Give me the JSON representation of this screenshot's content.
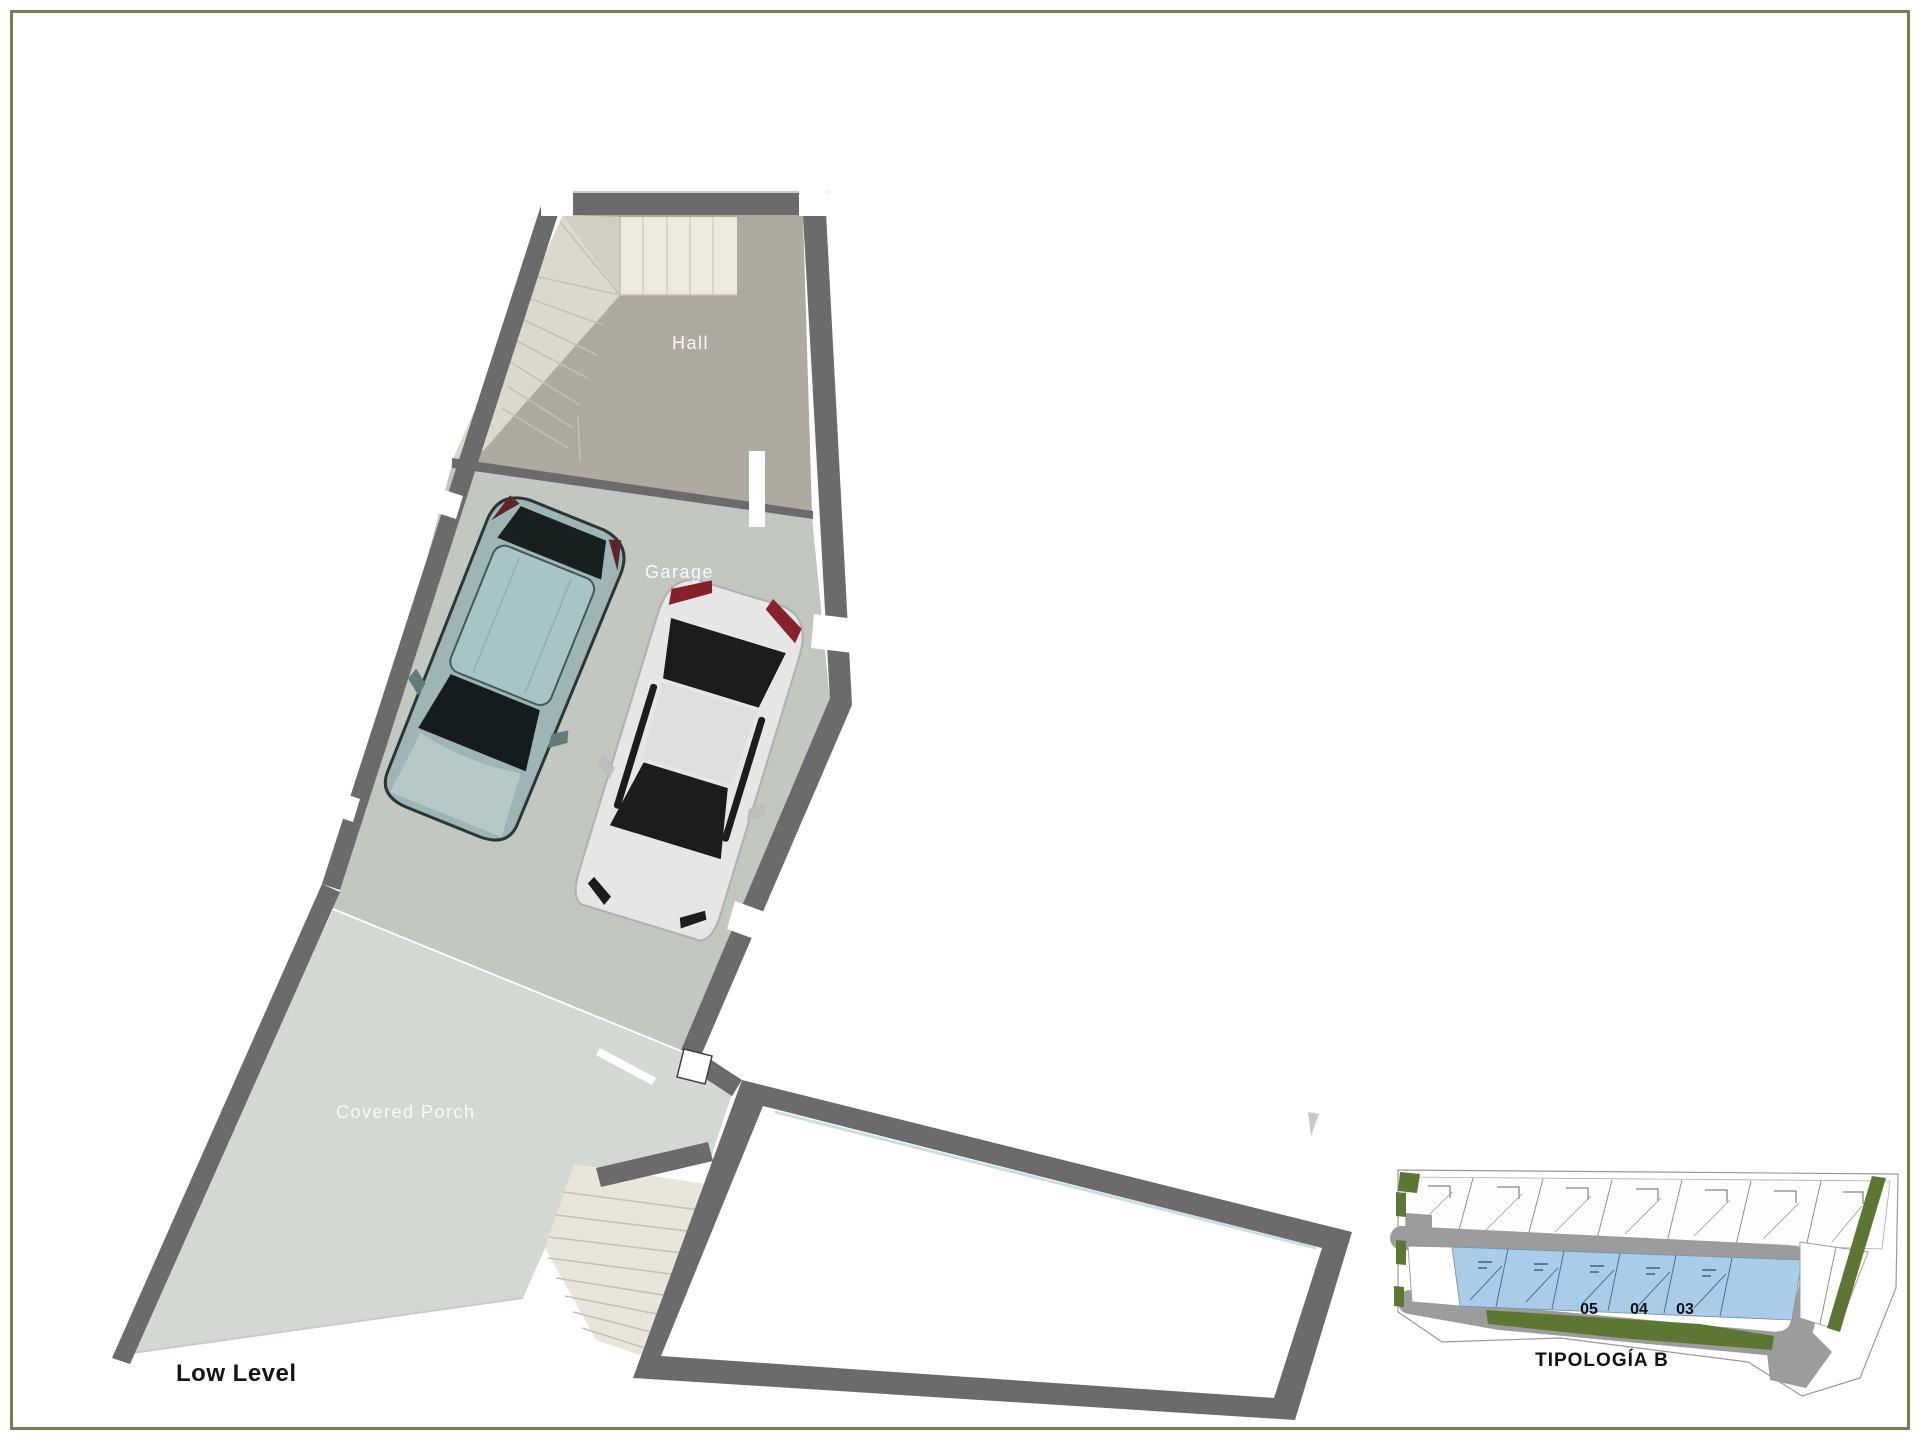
{
  "page": {
    "plan_title": "Low Level",
    "background": "#ffffff",
    "border_color": "#7c7c55"
  },
  "floor_plan": {
    "rooms": [
      {
        "label": "Hall"
      },
      {
        "label": "Garage"
      },
      {
        "label": "Covered Porch"
      }
    ],
    "colors": {
      "wall": "#6b6b6b",
      "hall_floor": "#aeaa9f",
      "stair_light": "#ece9dd",
      "stair_winder": "#dcd8cb",
      "stair_lower": "#e9e5da",
      "garage_floor": "#c2c7c0",
      "porch_floor": "#d3d8d3",
      "annex_interior": "#ffffff",
      "opening": "#ffffff",
      "label_text": "#fafafa",
      "title_text": "#151515"
    },
    "cars": [
      {
        "name": "teal-suv",
        "body": "#9fb5b5",
        "glass": "#a9c4c6",
        "dark": "#1d2629",
        "accent": "#5a262c"
      },
      {
        "name": "white-coupe",
        "body": "#e6e6e4",
        "dark": "#1f1f1f",
        "accent": "#86222d"
      }
    ]
  },
  "site_inset": {
    "title": "TIPOLOGÍA B",
    "unit_numbers": [
      "05",
      "04",
      "03"
    ],
    "colors": {
      "road": "#9c9c9c",
      "unit_highlight": "#a9cde9",
      "unit_line": "#4a7296",
      "green": "#5c7733",
      "outline": "#9a9a9a",
      "number_text": "#111111"
    }
  }
}
